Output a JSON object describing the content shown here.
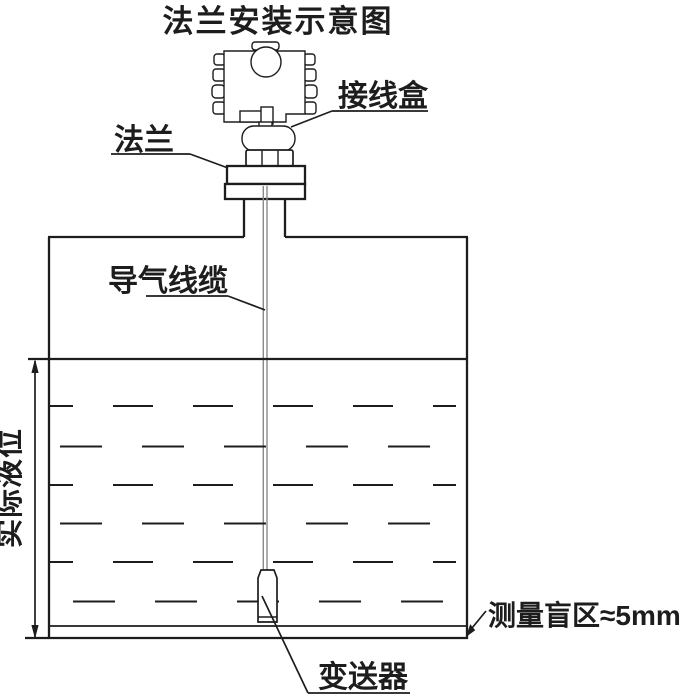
{
  "title": "法兰安装示意图",
  "labels": {
    "junction_box": "接线盒",
    "flange": "法兰",
    "air_cable": "导气线缆",
    "actual_level": "实际液位",
    "transmitter": "变送器",
    "blind_zone": "测量盲区≈5mm"
  },
  "colors": {
    "line": "#1d1d1d",
    "cable": "#8a8a8a",
    "background": "#ffffff"
  }
}
